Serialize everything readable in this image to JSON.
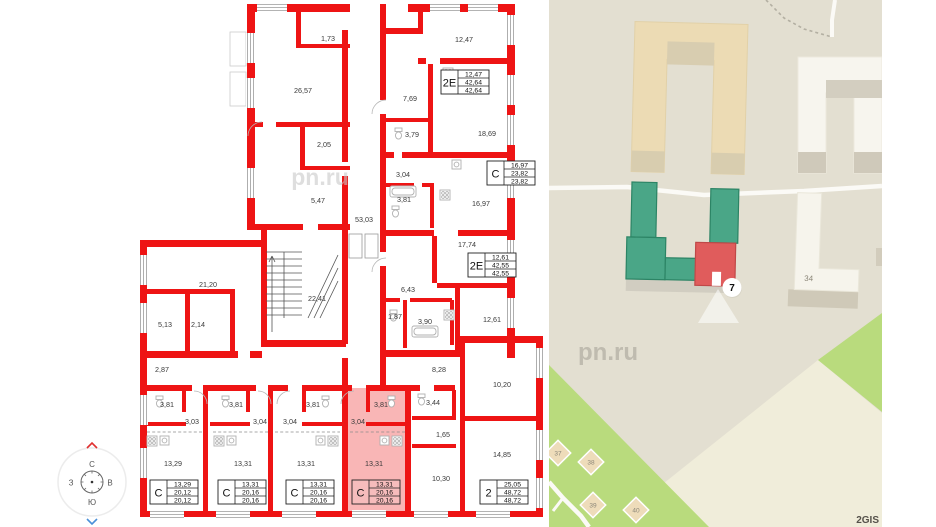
{
  "plan": {
    "watermark": "pn.ru",
    "room_labels": [
      {
        "t": "1,73",
        "x": 328,
        "y": 41
      },
      {
        "t": "26,57",
        "x": 303,
        "y": 93
      },
      {
        "t": "2,05",
        "x": 324,
        "y": 147
      },
      {
        "t": "5,47",
        "x": 318,
        "y": 203
      },
      {
        "t": "53,03",
        "x": 364,
        "y": 222
      },
      {
        "t": "12,47",
        "x": 464,
        "y": 42
      },
      {
        "t": "7,69",
        "x": 410,
        "y": 101
      },
      {
        "t": "3,79",
        "x": 412,
        "y": 137
      },
      {
        "t": "18,69",
        "x": 487,
        "y": 136
      },
      {
        "t": "3,04",
        "x": 403,
        "y": 177
      },
      {
        "t": "3,81",
        "x": 404,
        "y": 202
      },
      {
        "t": "16,97",
        "x": 481,
        "y": 206
      },
      {
        "t": "17,74",
        "x": 467,
        "y": 247
      },
      {
        "t": "6,43",
        "x": 408,
        "y": 292
      },
      {
        "t": "1,87",
        "x": 395,
        "y": 319
      },
      {
        "t": "3,90",
        "x": 425,
        "y": 324
      },
      {
        "t": "12,61",
        "x": 492,
        "y": 322
      },
      {
        "t": "21,20",
        "x": 208,
        "y": 287
      },
      {
        "t": "5,13",
        "x": 165,
        "y": 327
      },
      {
        "t": "2,14",
        "x": 198,
        "y": 327
      },
      {
        "t": "22,41",
        "x": 317,
        "y": 301
      },
      {
        "t": "2,87",
        "x": 162,
        "y": 372
      },
      {
        "t": "8,28",
        "x": 439,
        "y": 372
      },
      {
        "t": "10,20",
        "x": 502,
        "y": 387
      },
      {
        "t": "3,44",
        "x": 433,
        "y": 405
      },
      {
        "t": "1,65",
        "x": 443,
        "y": 437
      },
      {
        "t": "14,85",
        "x": 502,
        "y": 457
      },
      {
        "t": "10,30",
        "x": 441,
        "y": 481
      },
      {
        "t": "3,81",
        "x": 167,
        "y": 407
      },
      {
        "t": "3,03",
        "x": 192,
        "y": 424
      },
      {
        "t": "13,29",
        "x": 173,
        "y": 466
      },
      {
        "t": "3,81",
        "x": 236,
        "y": 407
      },
      {
        "t": "3,04",
        "x": 260,
        "y": 424
      },
      {
        "t": "13,31",
        "x": 243,
        "y": 466
      },
      {
        "t": "3,81",
        "x": 313,
        "y": 407
      },
      {
        "t": "3,04",
        "x": 290,
        "y": 424
      },
      {
        "t": "13,31",
        "x": 306,
        "y": 466
      },
      {
        "t": "3,81",
        "x": 381,
        "y": 407
      },
      {
        "t": "3,04",
        "x": 358,
        "y": 424
      },
      {
        "t": "13,31",
        "x": 374,
        "y": 466
      }
    ],
    "units": [
      {
        "type": "2Е",
        "top": "12,47",
        "mid": "42,64",
        "bot": "42,64"
      },
      {
        "type": "С",
        "top": "16,97",
        "mid": "23,82",
        "bot": "23,82"
      },
      {
        "type": "2Е",
        "top": "12,61",
        "mid": "42,55",
        "bot": "42,55"
      },
      {
        "type": "С",
        "top": "13,29",
        "mid": "20,12",
        "bot": "20,12"
      },
      {
        "type": "С",
        "top": "13,31",
        "mid": "20,16",
        "bot": "20,16"
      },
      {
        "type": "С",
        "top": "13,31",
        "mid": "20,16",
        "bot": "20,16"
      },
      {
        "type": "С",
        "top": "13,31",
        "mid": "20,16",
        "bot": "20,16"
      },
      {
        "type": "2",
        "top": "25,05",
        "mid": "48,72",
        "bot": "48,72"
      }
    ],
    "compass": {
      "n": "С",
      "e": "В",
      "s": "Ю",
      "w": "З"
    },
    "highlight_color": "#f05050"
  },
  "map": {
    "subject_marker": "7",
    "building_label": "34",
    "small_buildings": [
      {
        "t": "37",
        "x": 9,
        "y": 453
      },
      {
        "t": "38",
        "x": 42,
        "y": 462
      },
      {
        "t": "39",
        "x": 44,
        "y": 505
      },
      {
        "t": "40",
        "x": 87,
        "y": 510
      }
    ],
    "watermark": "pn.ru",
    "attribution": "2GIS",
    "colors": {
      "background": "#e3dfd1",
      "cream": "#f0edda",
      "grass": "#b9db7d",
      "green_building": "#4aa687",
      "highlight_building": "#e05c5c",
      "tan_building": "#ecdbb4",
      "white_building": "#f7f5ee",
      "road": "#fbfaf6"
    }
  }
}
